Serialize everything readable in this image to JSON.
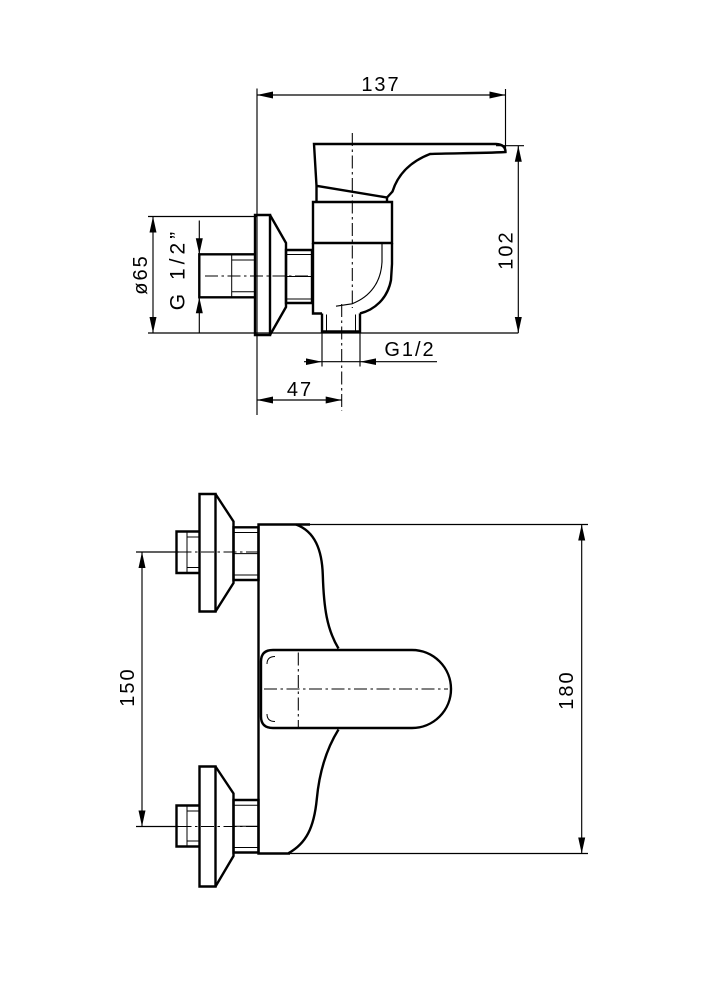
{
  "drawing": {
    "background": "#ffffff",
    "ink": "#000000"
  },
  "side_view": {
    "width_mm": "137",
    "height_mm": "102",
    "escutcheon_diameter": "ø65",
    "inlet_thread": "G 1/2”",
    "outlet_thread": "G1/2",
    "outlet_offset_mm": "47"
  },
  "front_view": {
    "inlet_spacing_mm": "150",
    "overall_height_mm": "180"
  }
}
